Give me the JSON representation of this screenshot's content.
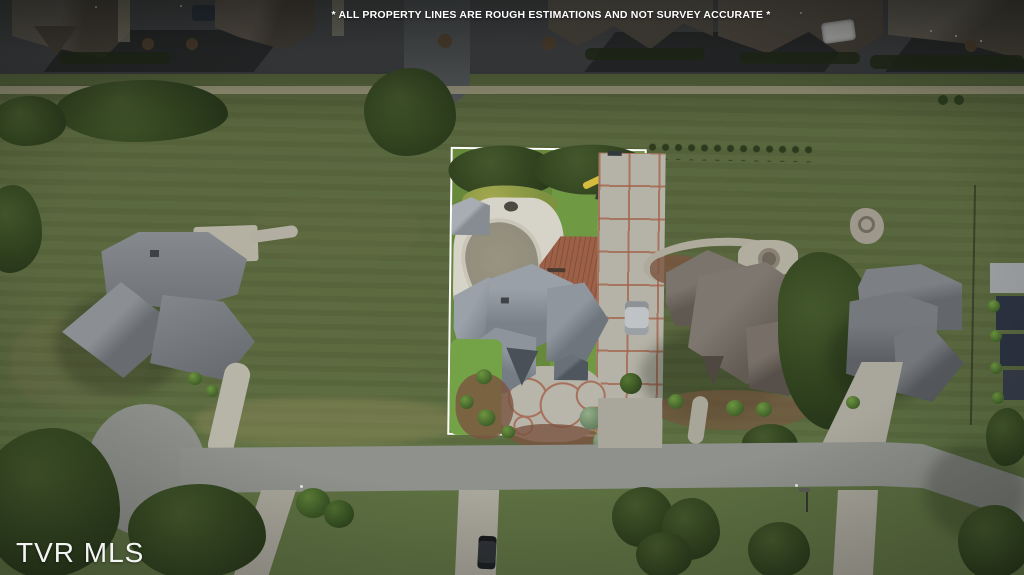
{
  "overlay": {
    "disclaimer": "* ALL PROPERTY LINES ARE ROUGH ESTIMATIONS AND NOT SURVEY ACCURATE *",
    "watermark": "TVR MLS"
  },
  "colors": {
    "outline": "#ffffff",
    "overlay_text": "#ffffff",
    "field_grass": "#57653c",
    "lot_grass": "#6c9140",
    "top_road": "#45474a",
    "bottom_road": "#8f918c",
    "sidewalk": "#a39e83",
    "apron": "#a9a69b",
    "concrete": "#b5b2a7",
    "stamped_accent": "#a2604a",
    "roof_center_house": "#8c939b",
    "roof_left_house": "#7c8084",
    "roof_right_house": "#6e6761",
    "roof_far_right_house": "#72757a",
    "roof_top_row": "#5c554b",
    "tree": "#31431f",
    "deck": "#9c6047",
    "pool_cover": "#8f8b7d",
    "pool_deck": "#d6d3c8",
    "mulch": "#8a5a42"
  }
}
